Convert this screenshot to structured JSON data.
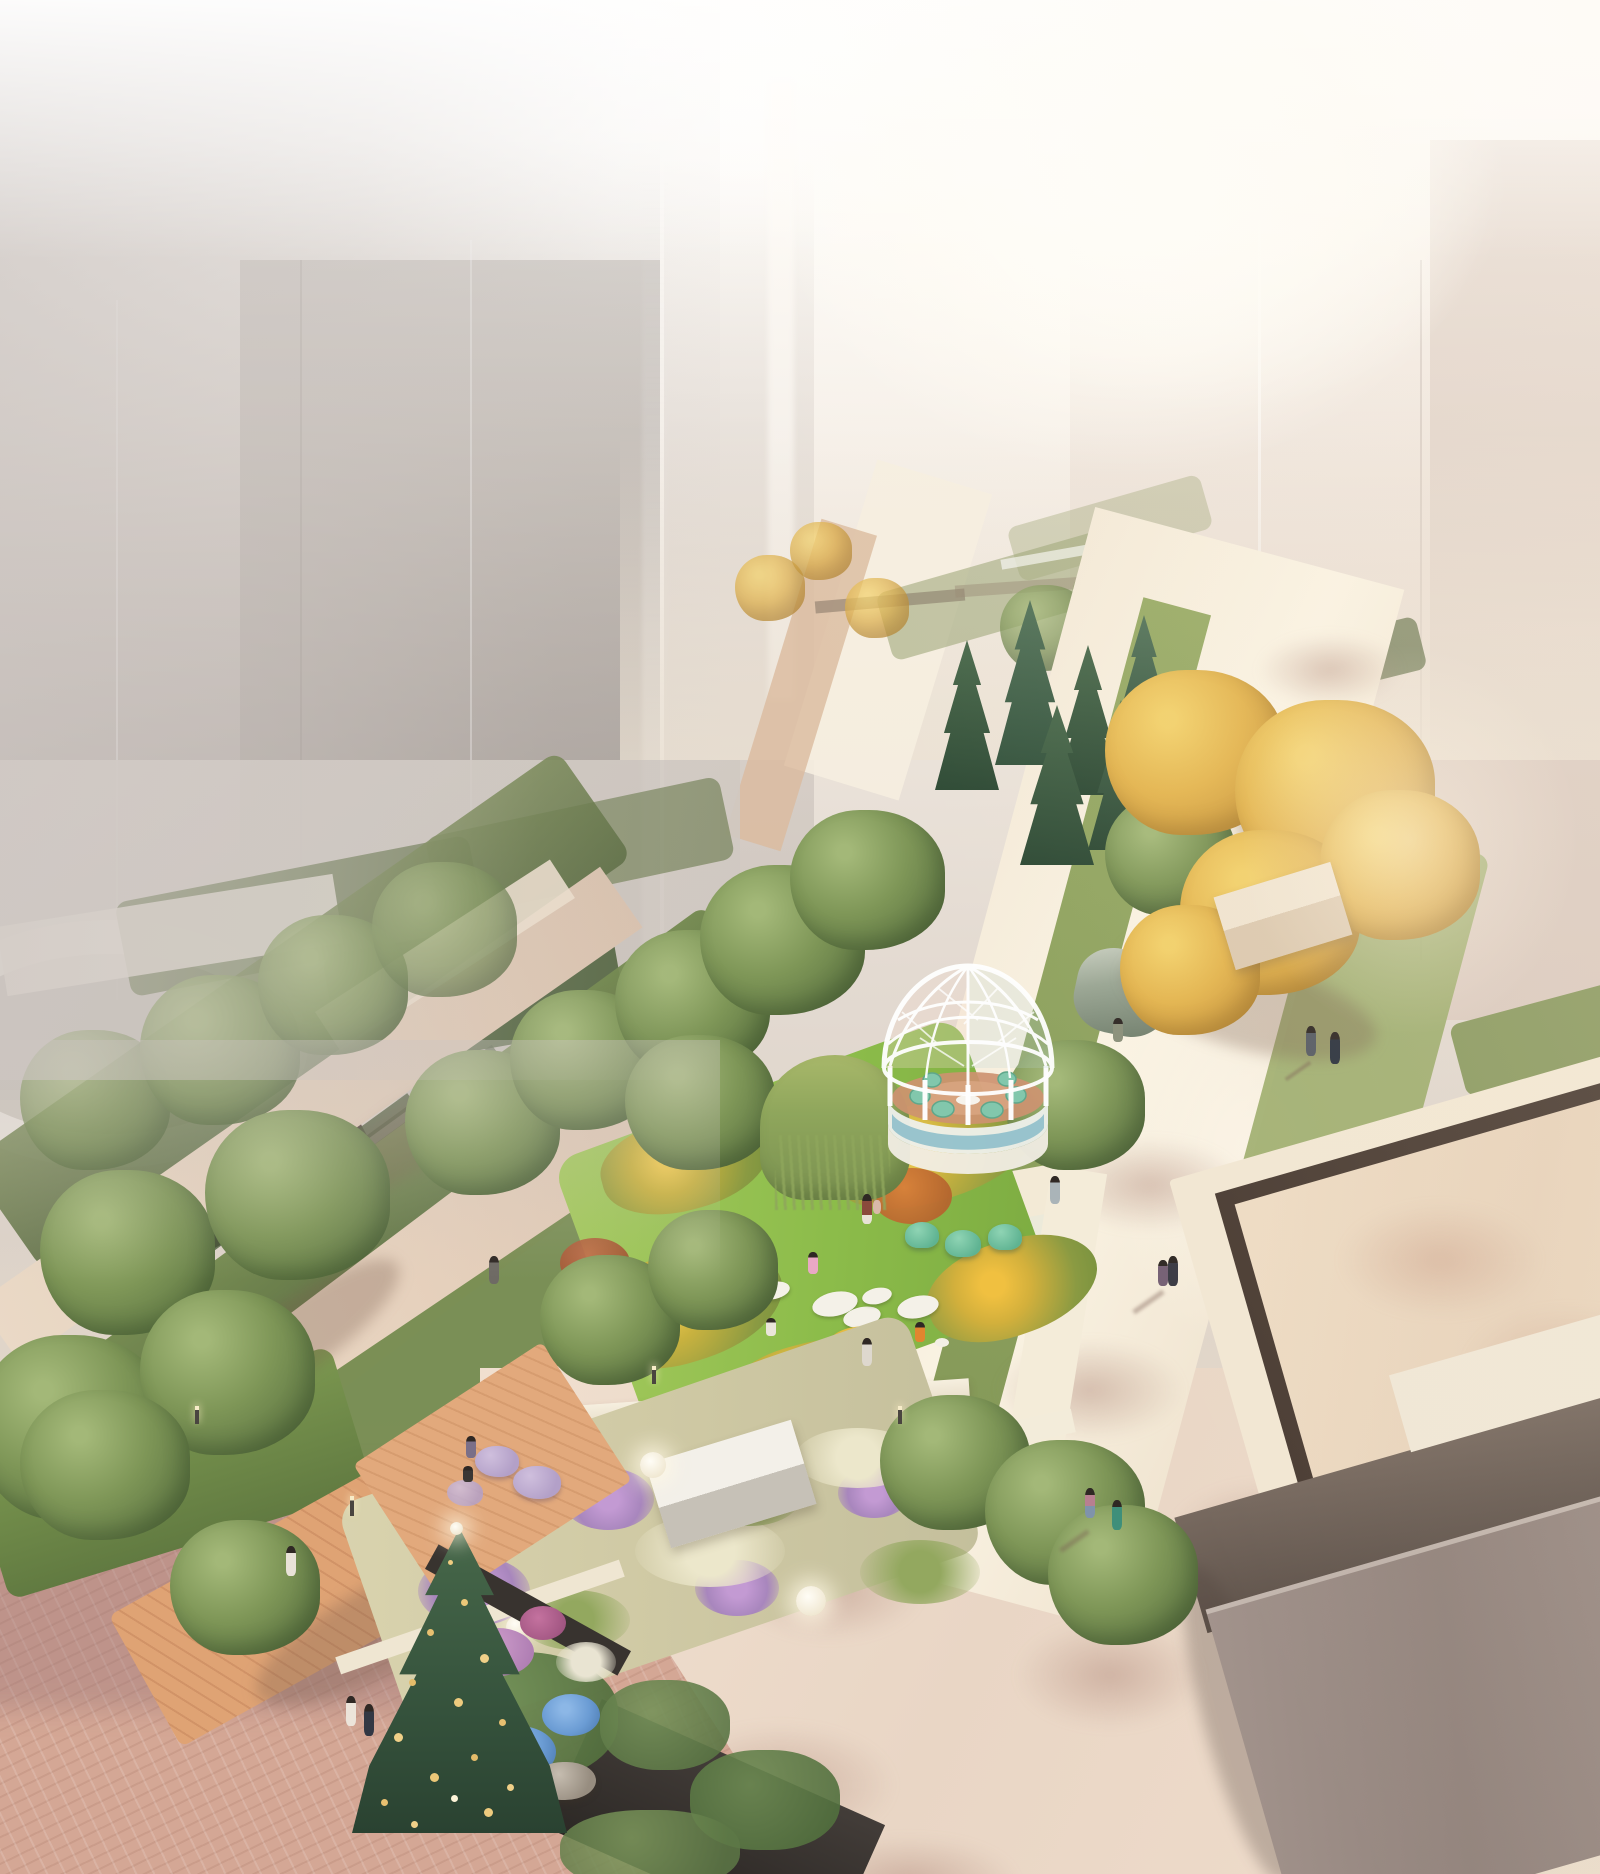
{
  "scene": {
    "type": "architectural-rendering",
    "title": "Aerial rendering of a linear garden park between hazy glass towers",
    "aria_label": "Sunlit aerial architectural rendering of a linear rooftop garden running diagonally between tall fog-veiled glass towers, with a white geodesic dome pavilion, lawns, flower meadows, golden ginkgo trees, a reflecting pool, brick plaza, decorated evergreen tree and small figures of people walking",
    "time_of_day": "hazy morning with warm sunlight from upper right",
    "people_count": 18,
    "landmarks": [
      {
        "name": "dome-pavilion",
        "description": "white geodesic lattice dome gazebo with teal lounge chairs on a terracotta floor and a curved white base"
      },
      {
        "name": "distant-dome",
        "description": "second smaller white dome pavilion far up the garden axis"
      },
      {
        "name": "central-lawn",
        "description": "bright green lawn with white oval stepping stones, a round yellow platform and yellow flower borders"
      },
      {
        "name": "grass-meadow",
        "description": "pale ornamental grass meadow with purple flower drifts, glowing sphere lamps and a white canopy structure"
      },
      {
        "name": "right-walkway",
        "description": "wide cream pedestrian promenade with dappled tree shadows"
      },
      {
        "name": "reflecting-pool",
        "description": "sunken rectangular water feature with dark rim and cream curb"
      },
      {
        "name": "gray-building",
        "description": "flat-roofed taupe building volume at lower right"
      },
      {
        "name": "brick-plaza",
        "description": "pink paver plaza at lower left with wooden boardwalk"
      },
      {
        "name": "decorated-tree",
        "description": "conical evergreen decorated with gold ornaments"
      },
      {
        "name": "hydrangea-bed",
        "description": "blue hydrangeas, pink shrubs and boulders in a corner planting bed"
      },
      {
        "name": "glass-towers",
        "description": "tall curtain-wall towers dissolving into white fog and light"
      }
    ],
    "palette": {
      "fog_white": "#fdfbf8",
      "tower_gray": "#aca4a0",
      "tower_rose": "#e2d4cb",
      "sun_glow": "#fdf3e2",
      "path_cream": "#f6eedd",
      "brick_pink": "#d4a795",
      "wood_deck": "#dca276",
      "lawn_green": "#8cbc4a",
      "tree_green": "#7e9657",
      "ginkgo_gold": "#e3b44e",
      "conifer_dark": "#35523c",
      "flower_yellow": "#ecc84e",
      "flower_purple": "#b590cb",
      "hydrangea_blue": "#6b9cd4",
      "seat_teal": "#82c7ac",
      "beanbag_lavender": "#b3a0c8",
      "pool_rim_dark": "#4a3c33",
      "pool_water": "#ead8c2",
      "building_taupe": "#92837c",
      "wall_charcoal": "#38332f"
    }
  }
}
